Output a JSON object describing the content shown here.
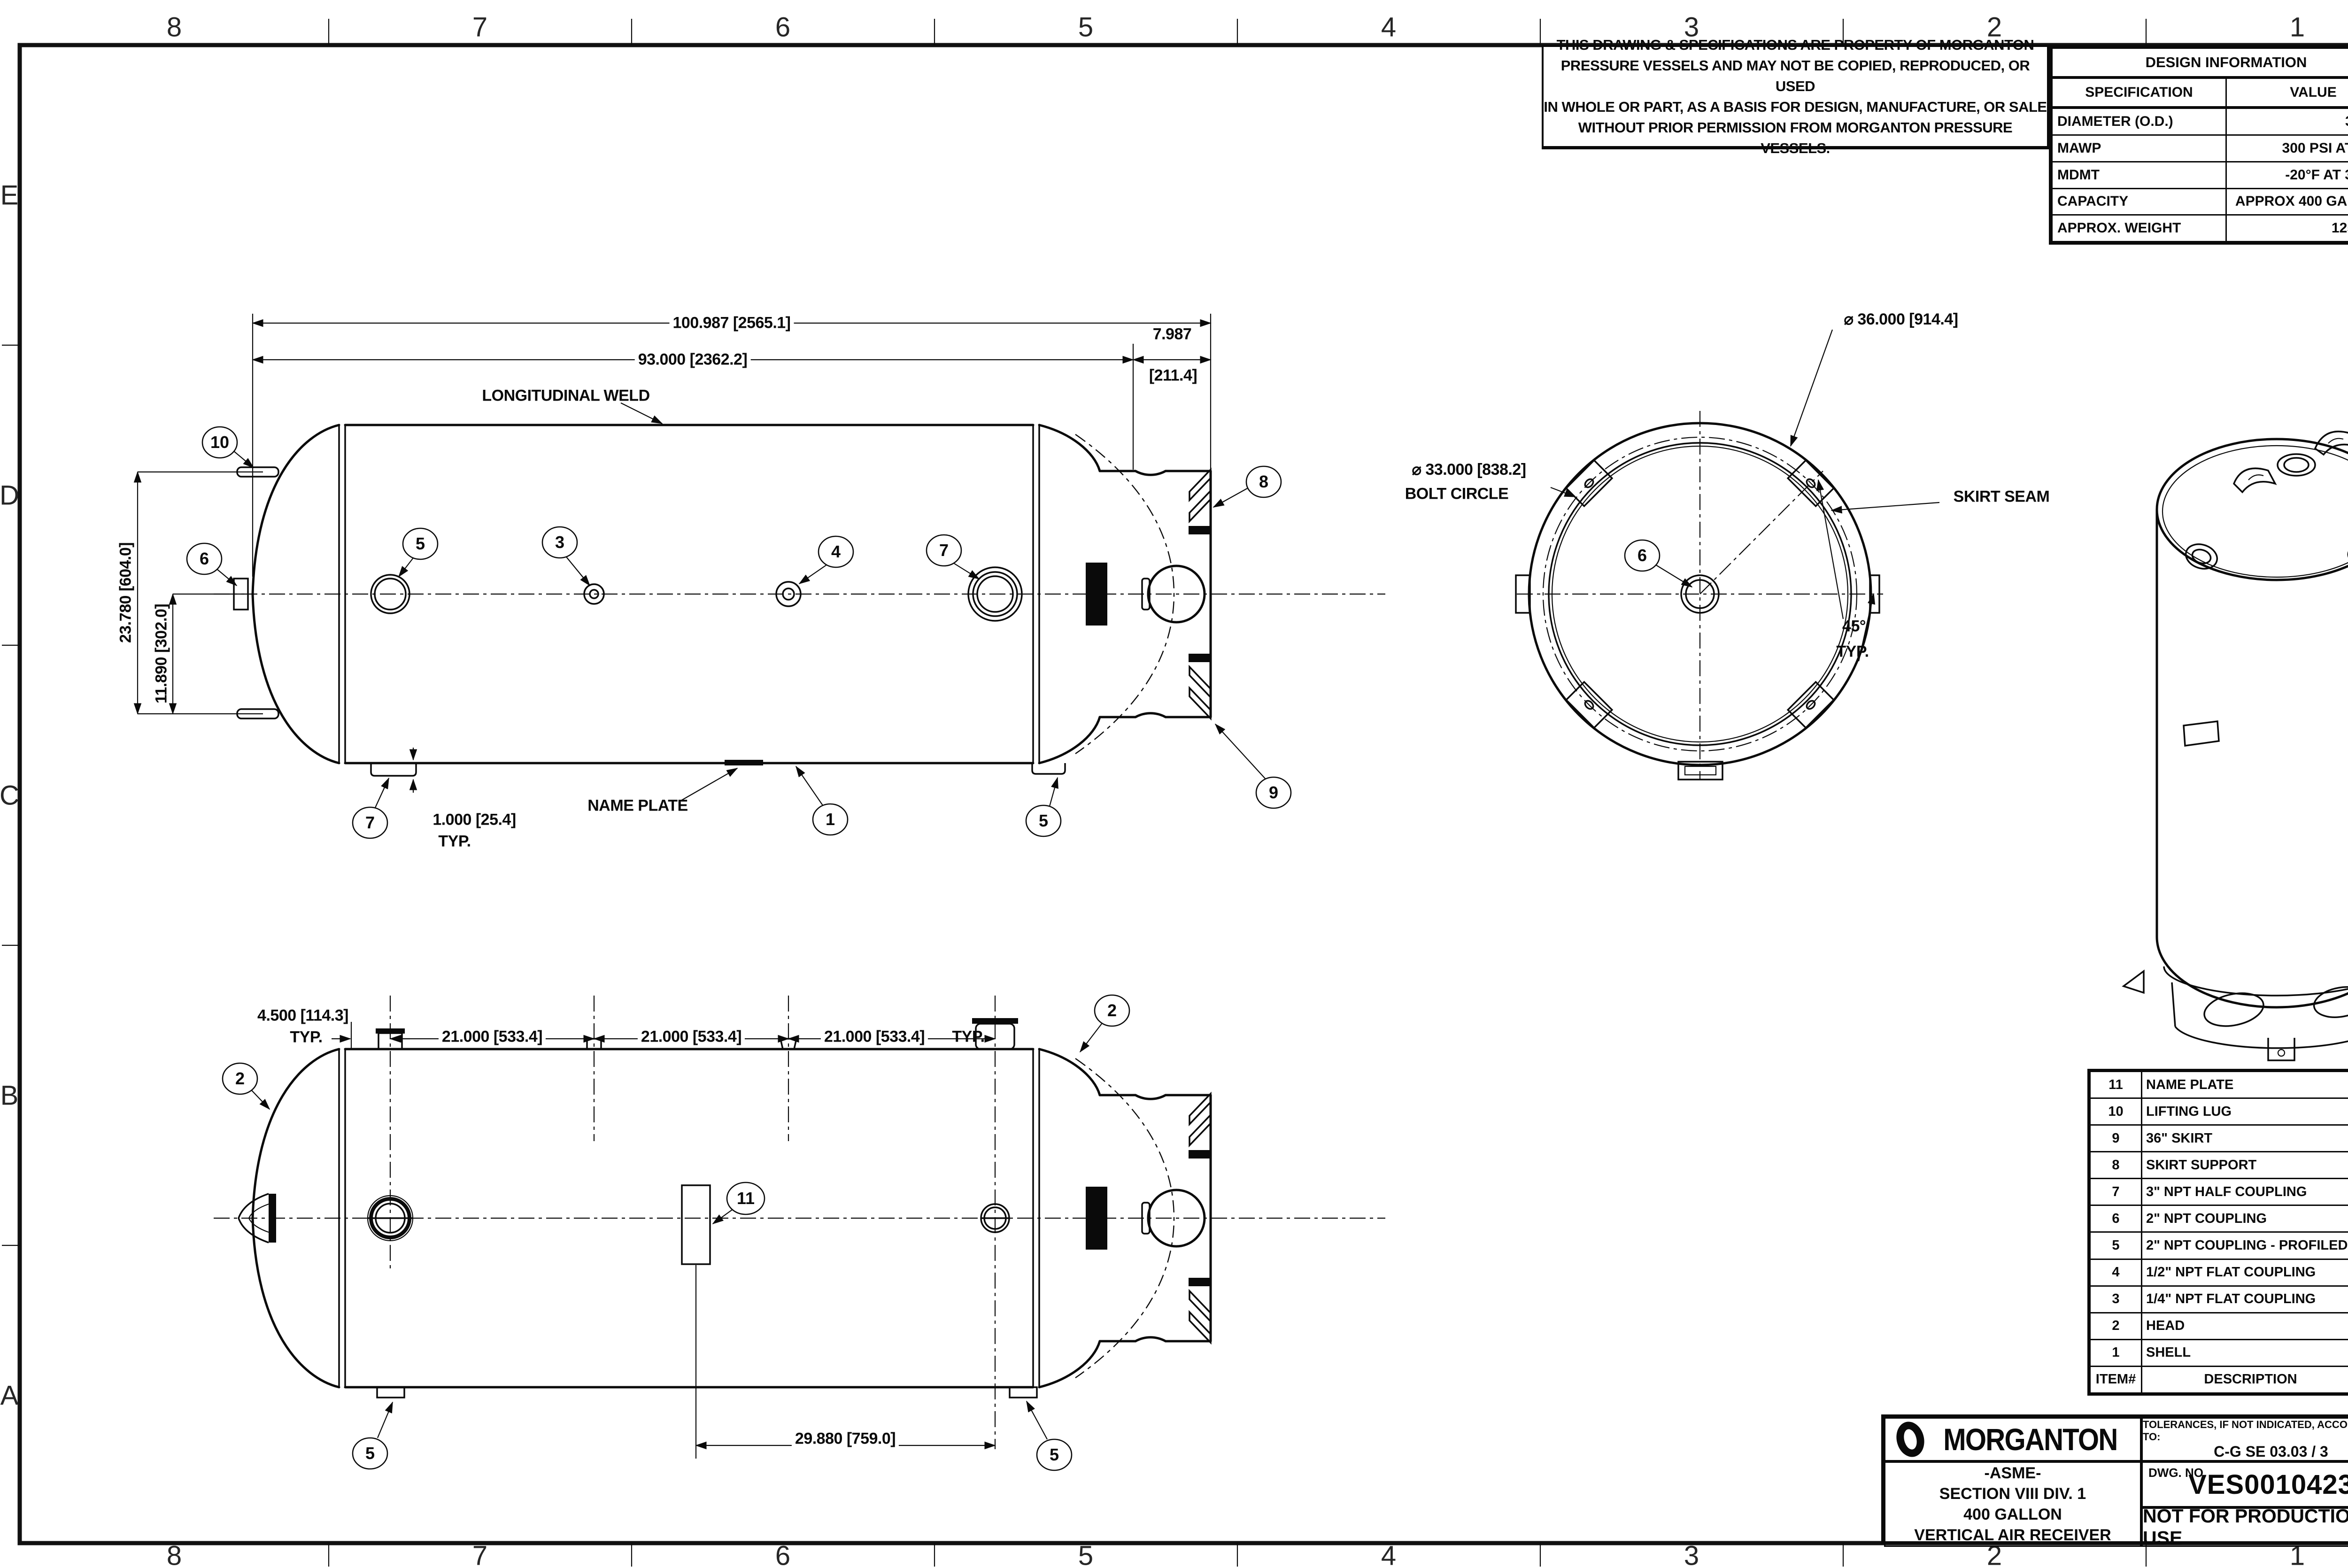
{
  "zones": {
    "cols": [
      "8",
      "7",
      "6",
      "5",
      "4",
      "3",
      "2",
      "1"
    ],
    "rows": [
      "E",
      "D",
      "C",
      "B",
      "A"
    ]
  },
  "copyright": {
    "lines": [
      "THIS DRAWING & SPECIFICATIONS ARE PROPERTY OF MORGANTON",
      "PRESSURE VESSELS AND MAY NOT BE COPIED, REPRODUCED,  OR USED",
      "IN WHOLE OR PART, AS A BASIS FOR DESIGN, MANUFACTURE, OR SALE",
      "WITHOUT PRIOR PERMISSION FROM MORGANTON PRESSURE VESSELS."
    ]
  },
  "design_info": {
    "title": "DESIGN INFORMATION",
    "col_headers": [
      "SPECIFICATION",
      "VALUE"
    ],
    "rows": [
      [
        "DIAMETER (O.D.)",
        "36.000\""
      ],
      [
        "MAWP",
        "300 PSI AT 650°F"
      ],
      [
        "MDMT",
        "-20°F AT 300 PSI"
      ],
      [
        "CAPACITY",
        "APPROX 400 GALLONS"
      ],
      [
        "APPROX. WEIGHT",
        "1250 LBS"
      ]
    ]
  },
  "parts_list": {
    "headers": [
      "ITEM#",
      "DESCRIPTION",
      "QTY."
    ],
    "rows": [
      [
        "11",
        "NAME PLATE",
        "1"
      ],
      [
        "10",
        "LIFTING LUG",
        "2"
      ],
      [
        "9",
        "36\" SKIRT",
        "1"
      ],
      [
        "8",
        "SKIRT SUPPORT",
        "4"
      ],
      [
        "7",
        "3\" NPT HALF COUPLING",
        "2"
      ],
      [
        "6",
        "2\" NPT COUPLING",
        "2"
      ],
      [
        "5",
        "2\" NPT COUPLING - PROFILED",
        "4"
      ],
      [
        "4",
        "1/2\" NPT FLAT COUPLING",
        "1"
      ],
      [
        "3",
        "1/4\" NPT FLAT COUPLING",
        "1"
      ],
      [
        "2",
        "HEAD",
        "2"
      ],
      [
        "1",
        "SHELL",
        "1"
      ]
    ]
  },
  "title_block": {
    "brand": "MORGANTON",
    "tolerances_label": "TOLERANCES, IF NOT INDICATED, ACCORDING TO:",
    "tolerances_value": "C-G SE 03.03 / 3",
    "product_lines": [
      "-ASME-",
      "SECTION VIII DIV. 1",
      "400 GALLON",
      "VERTICAL AIR RECEIVER"
    ],
    "dwg_no_label": "DWG. NO.",
    "dwg_no": "VES0010423",
    "status": "NOT FOR PRODUCTION USE"
  },
  "dims": {
    "overall": "100.987 [2565.1]",
    "shell_len": "93.000 [2362.2]",
    "skirt_len_in": "7.987",
    "skirt_len_mm": "[211.4]",
    "lug_span": "23.780 [604.0]",
    "lug_half": "11.890 [302.0]",
    "foot_offset": "1.000 [25.4]",
    "typ": "TYP.",
    "head_offset": "4.500 [114.3]",
    "coupling_pitch": "21.000 [533.4]",
    "np_offset": "29.880 [759.0]",
    "od": "⌀ 36.000 [914.4]",
    "bolt_circle_dia": "⌀ 33.000 [838.2]",
    "bolt_circle_label": "BOLT CIRCLE",
    "angle": "45°"
  },
  "notes": {
    "longitudinal_weld": "LONGITUDINAL WELD",
    "name_plate": "NAME PLATE",
    "skirt_seam": "SKIRT SEAM"
  },
  "callouts": {
    "c1": "1",
    "c2": "2",
    "c3": "3",
    "c4": "4",
    "c5": "5",
    "c6": "6",
    "c7": "7",
    "c8": "8",
    "c9": "9",
    "c10": "10",
    "c11": "11"
  }
}
